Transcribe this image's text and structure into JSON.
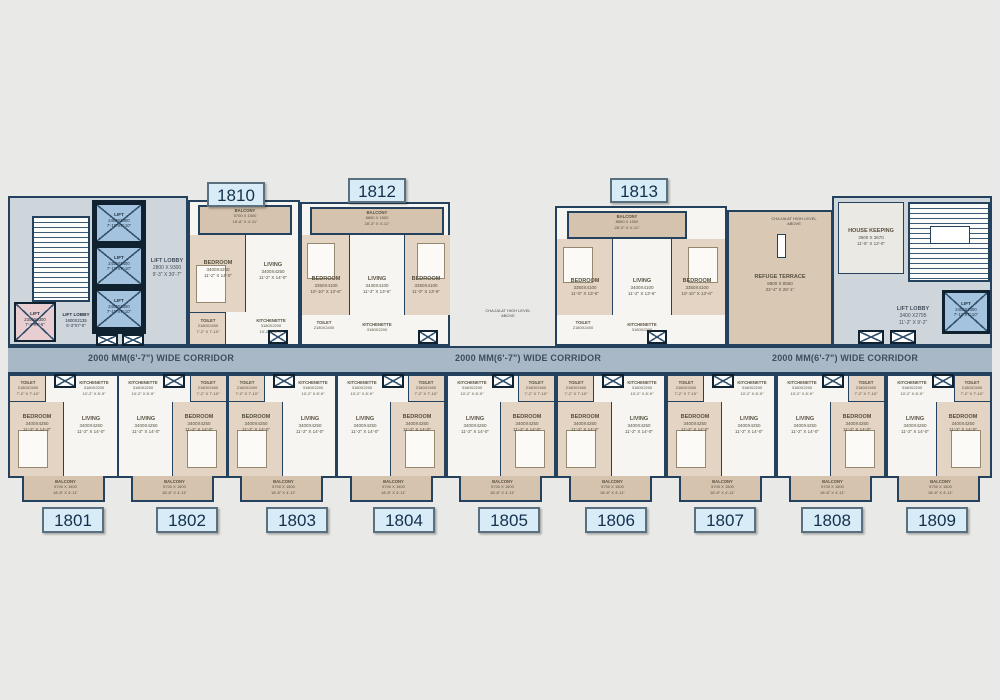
{
  "corridor": {
    "label": "2000 MM(6'-7\") WIDE CORRIDOR"
  },
  "rooms_common": {
    "bedroom": {
      "name": "BEDROOM",
      "mm": "3400X4250",
      "ft": "11'-2\" X 14'-0\""
    },
    "living": {
      "name": "LIVING",
      "mm": "3400X4250",
      "ft": "11'-2\" X 14'-0\""
    },
    "toilet": {
      "name": "TOILET",
      "mm": "2180X2400",
      "ft": "7'-2\" X 7'-10\""
    },
    "kitchenette": {
      "name": "KITCHENETTE",
      "mm": "3180X2200",
      "ft": "10'-2\" X 8'-9\""
    },
    "balcony": {
      "name": "BALCONY",
      "mm": "5700 X 1500",
      "ft": "18'-8\" X 4'-11\""
    }
  },
  "left_core": {
    "lift": {
      "name": "LIFT",
      "mm": "2400X2400",
      "ft": "7'-10\"X7'-10\""
    },
    "lift_lobby": {
      "name": "LIFT LOBBY",
      "mm": "2800 X 9300",
      "ft": "9'-3\" X 30'-7\""
    },
    "service_lift": {
      "name": "LIFT",
      "mm": "2300X2300",
      "ft": "7'-4\"X7'-6\""
    },
    "service_lift_lobby": {
      "name": "LIFT LOBBY",
      "mm": "1600X2135",
      "ft": "5'-3\"X7'-0\""
    }
  },
  "right_core": {
    "house_keeping": {
      "name": "HOUSE KEEPING",
      "mm": "3500 X 3670",
      "ft": "11'-6\" X 12'-0\""
    },
    "lift_lobby": {
      "name": "LIFT LOBBY",
      "mm": "3400 X2795",
      "ft": "11'-2\" X 9'-2\""
    },
    "lift": {
      "name": "LIFT",
      "mm": "2400X2400",
      "ft": "7'-10\"X7'-10\""
    }
  },
  "refuge": {
    "note_line1": "CHAJJA AT HIGH LEVEL",
    "note_line2": "ABOVE",
    "name": "REFUGE TERRACE",
    "mm": "6800 X 8550",
    "ft": "22'-4\" X 28'-1\""
  },
  "top_units": {
    "u1810": {
      "number": "1810",
      "balcony": {
        "name": "BALCONY",
        "mm": "5700 X 1500",
        "ft": "18'-8\" X 4'-11\""
      },
      "bedroom": {
        "name": "BEDROOM",
        "mm": "3400X4250",
        "ft": "11'-2\" X 14'-0\""
      },
      "living": {
        "name": "LIVING",
        "mm": "3400X4250",
        "ft": "11'-2\" X 14'-0\""
      }
    },
    "u1812": {
      "number": "1812",
      "balcony": {
        "name": "BALCONY",
        "mm": "8650 X 1500",
        "ft": "28'-3\" X 4'-11\""
      },
      "bedroom1": {
        "name": "BEDROOM",
        "mm": "3350X4100",
        "ft": "10'-10\" X 13'-6\""
      },
      "living": {
        "name": "LIVING",
        "mm": "3430X4100",
        "ft": "11'-2\" X 13'-6\""
      },
      "bedroom2": {
        "name": "BEDROOM",
        "mm": "3350X4100",
        "ft": "11'-0\" X 13'-6\""
      }
    },
    "u1813": {
      "number": "1813",
      "balcony": {
        "name": "BALCONY",
        "mm": "8650 X 1500",
        "ft": "28'-3\" X 4'-11\""
      },
      "bedroom1": {
        "name": "BEDROOM",
        "mm": "3350X4100",
        "ft": "11'-0\" X 13'-6\""
      },
      "living": {
        "name": "LIVING",
        "mm": "3400X4100",
        "ft": "11'-2\" X 13'-6\""
      },
      "bedroom2": {
        "name": "BEDROOM",
        "mm": "3350X4100",
        "ft": "10'-10\" X 13'-6\""
      }
    }
  },
  "bottom_units": [
    {
      "number": "1801"
    },
    {
      "number": "1802"
    },
    {
      "number": "1803"
    },
    {
      "number": "1804"
    },
    {
      "number": "1805"
    },
    {
      "number": "1806"
    },
    {
      "number": "1807"
    },
    {
      "number": "1808"
    },
    {
      "number": "1809"
    }
  ]
}
